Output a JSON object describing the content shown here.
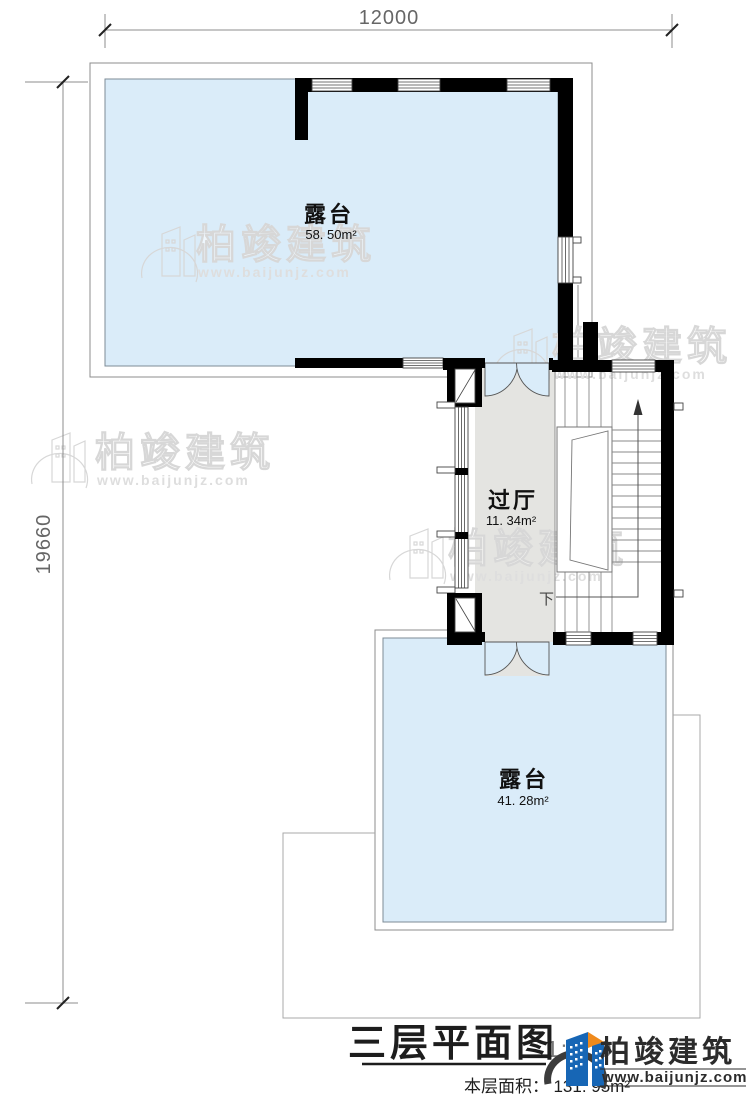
{
  "dimensions": {
    "top": "12000",
    "left": "19660"
  },
  "rooms": [
    {
      "name": "露台",
      "area": "58. 50m²"
    },
    {
      "name": "过厅",
      "area": "11. 34m²"
    },
    {
      "name": "露台",
      "area": "41. 28m²"
    }
  ],
  "stairs": {
    "down_label": "下"
  },
  "watermark": {
    "name": "柏竣建筑",
    "url": "www.baijunjz.com"
  },
  "titleblock": {
    "title": "三层平面图",
    "scale": "1:100",
    "area_prefix": "本层面积：",
    "area_value": "131. 95m²"
  },
  "brand": {
    "name": "柏竣建筑",
    "url": "www.baijunjz.com"
  },
  "colors": {
    "terrace": "#daecf9",
    "hall": "#e4e4e1",
    "wall": "#000000",
    "brand_blue": "#1766b5",
    "brand_orange": "#ef8a1c"
  }
}
